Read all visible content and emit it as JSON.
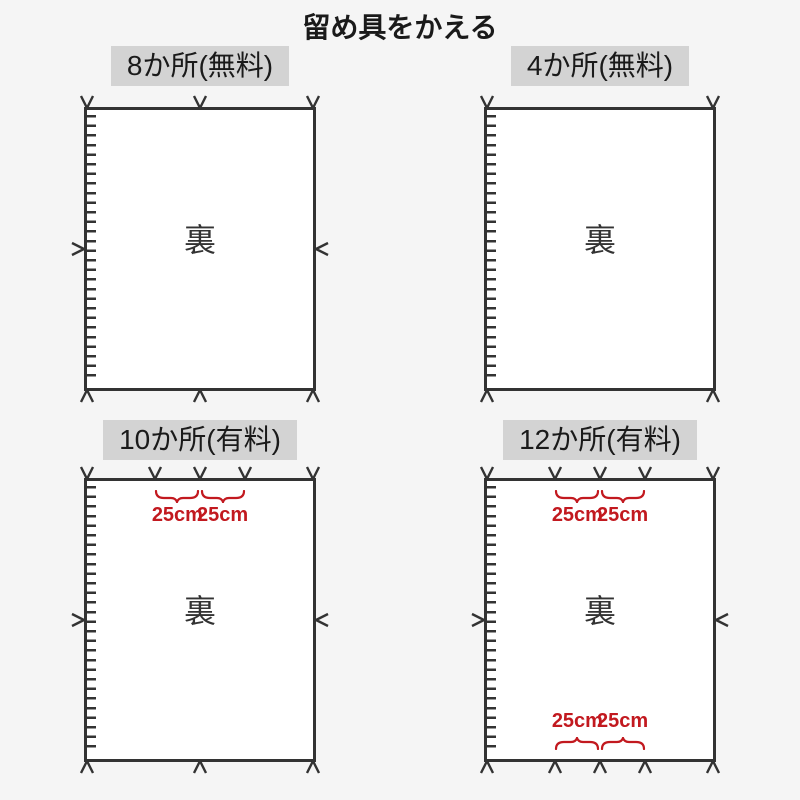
{
  "title": "留め具をかえる",
  "back_label": "裏",
  "colors": {
    "background": "#f5f5f5",
    "panel_fill": "#ffffff",
    "ink": "#333333",
    "badge_background": "#d3d3d3",
    "accent_red": "#c2191f"
  },
  "panels": [
    {
      "label": "8か所(無料)",
      "fastener_count": 8,
      "marks": {
        "top_pct": [
          0,
          50,
          100
        ],
        "bottom_pct": [
          0,
          50,
          100
        ],
        "left_mid": true,
        "right_mid": true
      },
      "braces": {
        "top": [],
        "bottom": []
      }
    },
    {
      "label": "4か所(無料)",
      "fastener_count": 4,
      "marks": {
        "top_pct": [
          0,
          100
        ],
        "bottom_pct": [
          0,
          100
        ],
        "left_mid": false,
        "right_mid": false
      },
      "braces": {
        "top": [],
        "bottom": []
      }
    },
    {
      "label": "10か所(有料)",
      "fastener_count": 10,
      "marks": {
        "top_pct": [
          0,
          30,
          50,
          70,
          100
        ],
        "bottom_pct": [
          0,
          50,
          100
        ],
        "left_mid": true,
        "right_mid": true
      },
      "braces": {
        "top": [
          {
            "label": "25cm"
          },
          {
            "label": "25cm"
          }
        ],
        "bottom": []
      }
    },
    {
      "label": "12か所(有料)",
      "fastener_count": 12,
      "marks": {
        "top_pct": [
          0,
          30,
          50,
          70,
          100
        ],
        "bottom_pct": [
          0,
          30,
          50,
          70,
          100
        ],
        "left_mid": true,
        "right_mid": true
      },
      "braces": {
        "top": [
          {
            "label": "25cm"
          },
          {
            "label": "25cm"
          }
        ],
        "bottom": [
          {
            "label": "25cm"
          },
          {
            "label": "25cm"
          }
        ]
      }
    }
  ]
}
